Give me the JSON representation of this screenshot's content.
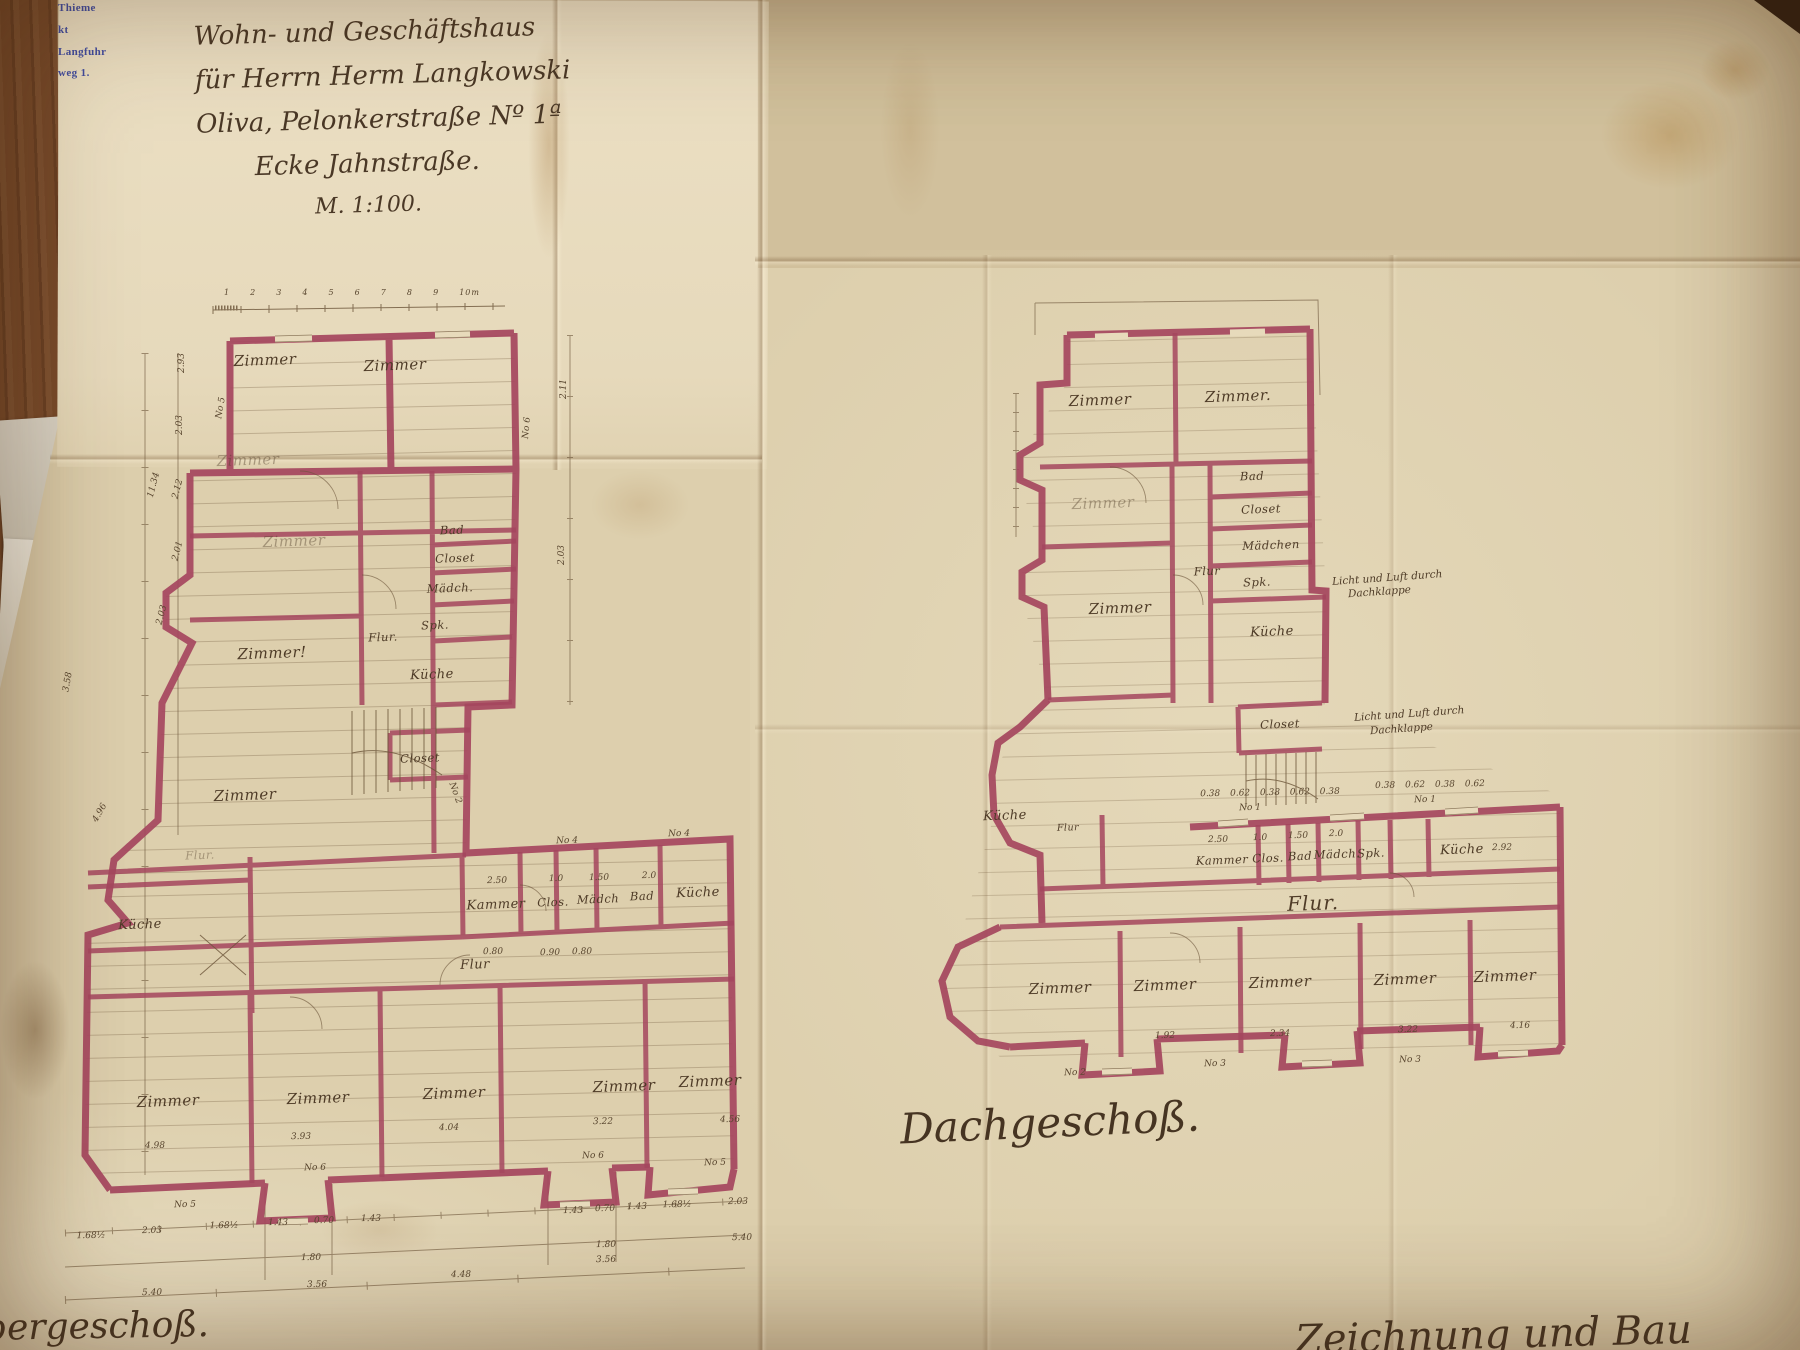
{
  "stamp": {
    "lines": [
      "Thieme",
      "kt",
      "Langfuhr",
      "weg 1."
    ],
    "color": "#2e3d9e"
  },
  "title_block": {
    "lines": [
      "Wohn- und Geschäftshaus",
      "für Herrn Herm Langkowski",
      "Oliva, Pelonkerstraße Nº 1ª",
      "Ecke Jahnstraße.",
      "M. 1:100."
    ]
  },
  "scale_bar": {
    "labels": "1 2 3 4 5 6 7 8 9 10m"
  },
  "plan_left": {
    "caption": "bergeschoß.",
    "rooms": [
      "Zimmer",
      "Zimmer",
      "Zimmer",
      "Bad",
      "Closet",
      "Mädch.",
      "Spk.",
      "Flur.",
      "Küche",
      "Zimmer!",
      "Zimmer",
      "Closet",
      "Zimmer",
      "Küche",
      "Flur.",
      "Kammer",
      "Clos.",
      "Mädch",
      "Bad",
      "Küche",
      "Flur",
      "Zimmer",
      "Zimmer",
      "Zimmer",
      "Zimmer",
      "Zimmer"
    ],
    "dims": [
      "2.93",
      "2.03",
      "11.34",
      "2.12",
      "2.01",
      "2.03",
      "3.58",
      "4.96",
      "2.11",
      "2.03",
      "2.50",
      "1.0",
      "1.50",
      "2.0",
      "0.80",
      "0.90",
      "0.80",
      "4.98",
      "3.93",
      "4.04",
      "3.22",
      "4.56",
      "1.68½",
      "2.03",
      "1.68½",
      "1.43",
      "0.70",
      "1.43",
      "1.43",
      "0.70",
      "1.43",
      "1.68½",
      "2.03",
      "1.80",
      "1.80",
      "5.40",
      "3.56",
      "4.48",
      "3.56",
      "5.40"
    ],
    "windows": [
      "No 5",
      "No 6",
      "No 2",
      "No 4",
      "No 4",
      "No 6",
      "No 5",
      "No 6",
      "No 5"
    ]
  },
  "plan_right": {
    "caption": "Dachgeschoß.",
    "rooms": [
      "Zimmer",
      "Zimmer.",
      "Zimmer",
      "Bad",
      "Closet",
      "Mädchen",
      "Spk.",
      "Küche",
      "Flur",
      "Zimmer",
      "Closet",
      "Küche",
      "Flur",
      "Kammer",
      "Clos.",
      "Bad",
      "Mädch.",
      "Spk.",
      "Küche",
      "Flur.",
      "Zimmer",
      "Zimmer",
      "Zimmer",
      "Zimmer",
      "Zimmer"
    ],
    "notes": [
      "Licht und Luft durch",
      "Dachklappe",
      "Licht und Luft durch",
      "Dachklappe"
    ],
    "dims": [
      "0.38 0.62 0.38 0.62 0.38",
      "0.38 0.62 0.38 0.62",
      "2.50",
      "1.0",
      "1.50",
      "2.0",
      "2.92",
      "1.92",
      "2.34",
      "3.22",
      "4.16"
    ],
    "windows": [
      "No 1",
      "No 1",
      "No 3",
      "No 3",
      "No 2"
    ]
  },
  "bottom_right_fragment": "Zeichnung und Bau",
  "colors": {
    "wall": "#a5465e",
    "ink": "#6b5438",
    "paper": "#ddcfad",
    "stamp_blue": "#2e3d9e"
  }
}
